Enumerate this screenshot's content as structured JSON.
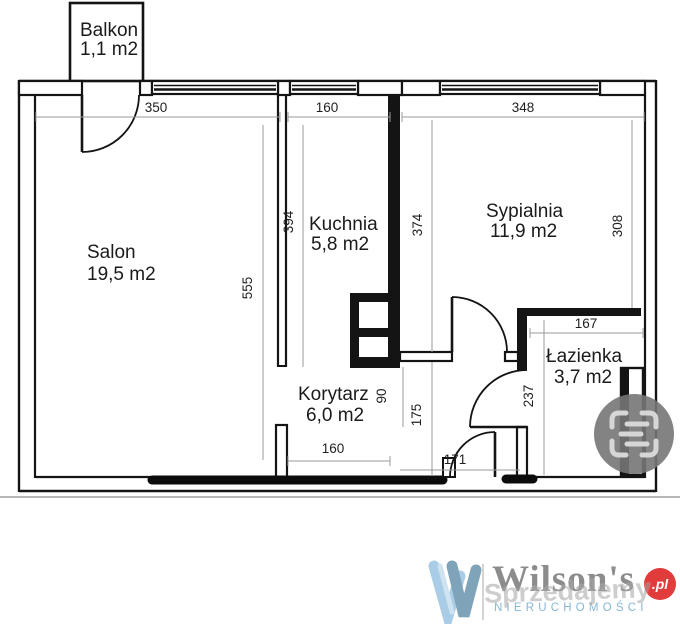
{
  "plan": {
    "rooms": {
      "balkon": {
        "name": "Balkon",
        "area": "1,1 m2"
      },
      "salon": {
        "name": "Salon",
        "area": "19,5 m2"
      },
      "kuchnia": {
        "name": "Kuchnia",
        "area": "5,8 m2"
      },
      "sypialnia": {
        "name": "Sypialnia",
        "area": "11,9 m2"
      },
      "korytarz": {
        "name": "Korytarz",
        "area": "6,0 m2"
      },
      "lazienka": {
        "name": "Łazienka",
        "area": "3,7 m2"
      }
    },
    "dims": {
      "top_salon": "350",
      "top_kitchen": "160",
      "top_bedroom": "348",
      "salon_height": "555",
      "kitchen_height": "394",
      "bedroom_left": "374",
      "bedroom_right": "308",
      "bath_width": "167",
      "bath_height": "237",
      "opening": "90",
      "corridor_right": "175",
      "corridor_bottom": "160",
      "entrance_bottom": "171"
    },
    "colors": {
      "wall": "#141414",
      "dim_line": "#999999",
      "dim_text": "#1f1f1f"
    }
  },
  "branding": {
    "watermark": "Sprzedajemy",
    "logo_name": "Wilson's",
    "logo_sub": "NIERUCHOMOŚCI",
    "logo_badge": ".pl",
    "colors": {
      "logo_name": "#8c8c8c",
      "logo_sub": "#85b7d4",
      "badge": "#e23b3b",
      "w_light": "#a9cde6",
      "w_dark": "#7fa3b8"
    }
  }
}
